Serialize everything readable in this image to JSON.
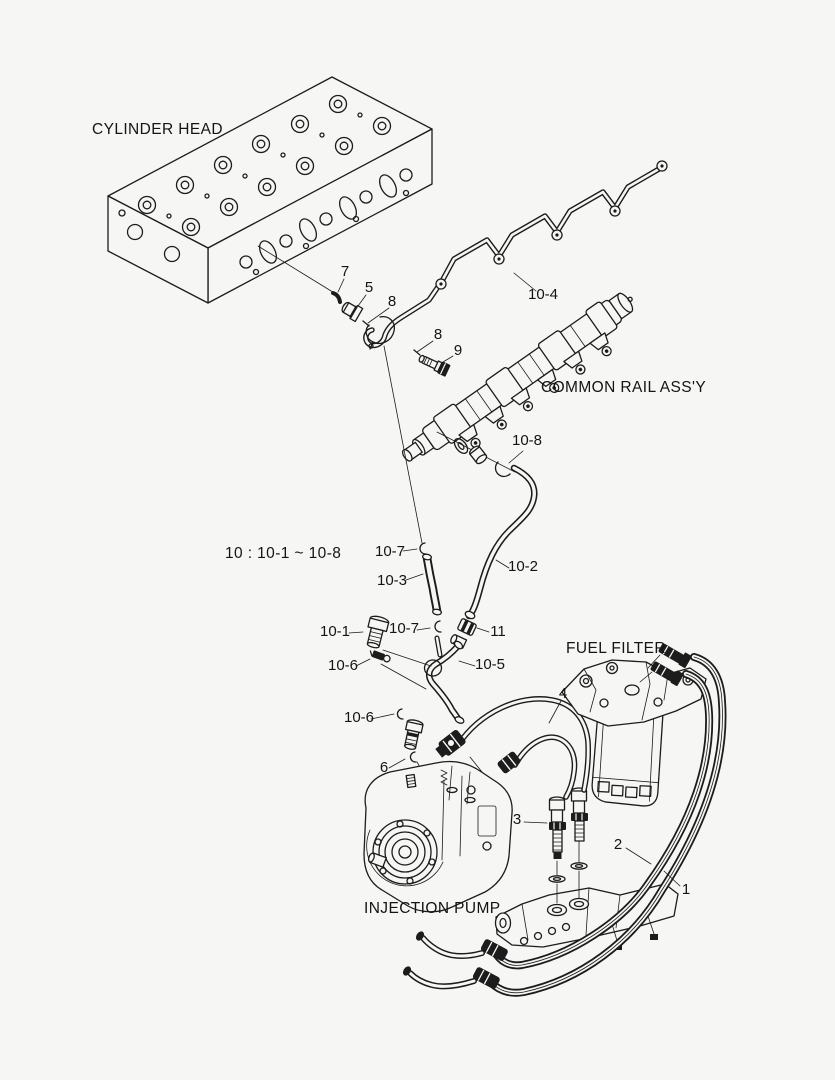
{
  "canvas": {
    "background_color": "#f6f6f4",
    "line_color": "#1c1c1c"
  },
  "component_labels": [
    {
      "id": "cylinder-head",
      "text": "CYLINDER HEAD"
    },
    {
      "id": "common-rail",
      "text": "COMMON RAIL ASS'Y"
    },
    {
      "id": "fuel-filter",
      "text": "FUEL FILTER"
    },
    {
      "id": "injection-pump",
      "text": "INJECTION PUMP"
    }
  ],
  "group_note": "10 : 10-1 ~ 10-8",
  "part_labels": [
    {
      "ref": "7"
    },
    {
      "ref": "5"
    },
    {
      "ref": "8"
    },
    {
      "ref": "10-4"
    },
    {
      "ref": "8"
    },
    {
      "ref": "9"
    },
    {
      "ref": "10-8"
    },
    {
      "ref": "10-7"
    },
    {
      "ref": "10-3"
    },
    {
      "ref": "10-2"
    },
    {
      "ref": "10-1"
    },
    {
      "ref": "10-7"
    },
    {
      "ref": "11"
    },
    {
      "ref": "10-6"
    },
    {
      "ref": "10-5"
    },
    {
      "ref": "4"
    },
    {
      "ref": "10-6"
    },
    {
      "ref": "6"
    },
    {
      "ref": "3"
    },
    {
      "ref": "2"
    },
    {
      "ref": "1"
    }
  ]
}
